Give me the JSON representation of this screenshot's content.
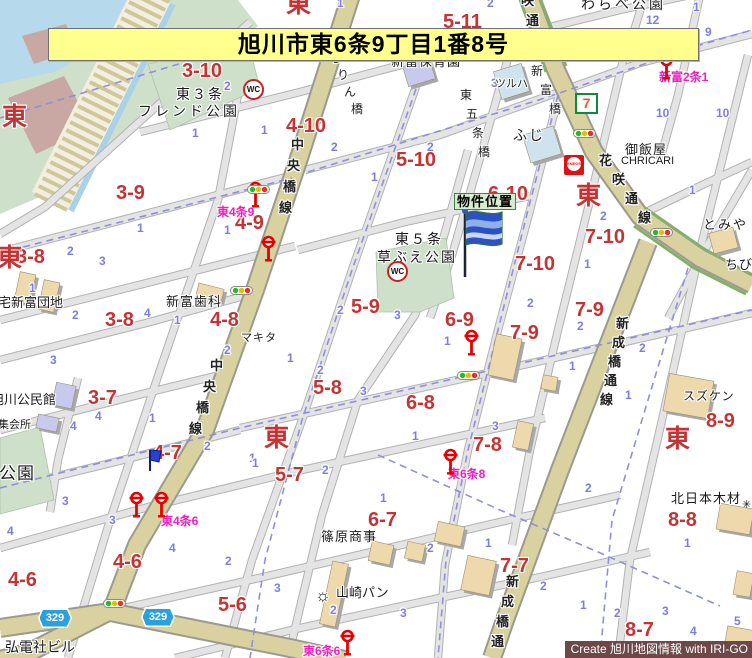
{
  "banner": {
    "title": "旭川市東6条9丁目1番8号"
  },
  "credit": {
    "text": "Create 旭川地図情報 with IRI-GO"
  },
  "property_marker": {
    "label": "物件位置"
  },
  "route_badges": [
    {
      "label": "329",
      "x": 38,
      "y": 608
    },
    {
      "label": "329",
      "x": 141,
      "y": 607
    }
  ],
  "map": {
    "road_names": [
      {
        "text": "中央橋線",
        "x": 291,
        "y": 138,
        "dx": -4,
        "dy": 21
      },
      {
        "text": "中央橋線",
        "x": 210,
        "y": 359,
        "dx": -7,
        "dy": 21
      },
      {
        "text": "新成橋通線",
        "x": 616,
        "y": 317,
        "dx": -4,
        "dy": 19
      },
      {
        "text": "新成橋通",
        "x": 506,
        "y": 575,
        "dx": -5,
        "dy": 20
      },
      {
        "text": "花咲通線",
        "x": 599,
        "y": 154,
        "dx": 13,
        "dy": 19
      },
      {
        "text": "咲通",
        "x": 521,
        "y": -6,
        "dx": 5,
        "dy": 20
      }
    ],
    "bridge_names": [
      {
        "text": "ろりん橋",
        "x": 330,
        "y": 52,
        "dx": 7,
        "dy": 17
      },
      {
        "text": "東五条橋",
        "x": 460,
        "y": 89,
        "dx": 6,
        "dy": 19
      },
      {
        "text": "新富橋",
        "x": 531,
        "y": 65,
        "dx": 9,
        "dy": 19
      }
    ],
    "district_marks": [
      {
        "text": "東",
        "x": 2,
        "y": 105
      },
      {
        "text": "東",
        "x": -3,
        "y": 246
      },
      {
        "text": "東",
        "x": 286,
        "y": -8
      },
      {
        "text": "東",
        "x": 576,
        "y": 184
      },
      {
        "text": "東",
        "x": 264,
        "y": 426
      },
      {
        "text": "東",
        "x": 665,
        "y": 427
      }
    ],
    "block_numbers": [
      {
        "text": "3-10",
        "x": 182,
        "y": 61
      },
      {
        "text": "4-10",
        "x": 286,
        "y": 116
      },
      {
        "text": "5-10",
        "x": 396,
        "y": 150
      },
      {
        "text": "5-11",
        "x": 443,
        "y": 12
      },
      {
        "text": "6-10",
        "x": 488,
        "y": 184
      },
      {
        "text": "7-10",
        "x": 515,
        "y": 254
      },
      {
        "text": "7-10",
        "x": 585,
        "y": 227
      },
      {
        "text": "3-9",
        "x": 116,
        "y": 183
      },
      {
        "text": "4-9",
        "x": 235,
        "y": 213
      },
      {
        "text": "3-8",
        "x": 16,
        "y": 247
      },
      {
        "text": "3-8",
        "x": 105,
        "y": 310
      },
      {
        "text": "4-8",
        "x": 210,
        "y": 310
      },
      {
        "text": "5-9",
        "x": 351,
        "y": 297
      },
      {
        "text": "6-9",
        "x": 445,
        "y": 310
      },
      {
        "text": "7-9",
        "x": 510,
        "y": 323
      },
      {
        "text": "7-9",
        "x": 575,
        "y": 300
      },
      {
        "text": "5-8",
        "x": 313,
        "y": 378
      },
      {
        "text": "6-8",
        "x": 406,
        "y": 393
      },
      {
        "text": "7-8",
        "x": 473,
        "y": 435
      },
      {
        "text": "8-9",
        "x": 706,
        "y": 411
      },
      {
        "text": "3-7",
        "x": 88,
        "y": 388
      },
      {
        "text": "4-7",
        "x": 153,
        "y": 443
      },
      {
        "text": "5-7",
        "x": 275,
        "y": 465
      },
      {
        "text": "6-7",
        "x": 368,
        "y": 510
      },
      {
        "text": "7-7",
        "x": 500,
        "y": 556
      },
      {
        "text": "8-8",
        "x": 668,
        "y": 510
      },
      {
        "text": "8-7",
        "x": 625,
        "y": 620
      },
      {
        "text": "4-6",
        "x": 8,
        "y": 570
      },
      {
        "text": "4-6",
        "x": 113,
        "y": 552
      },
      {
        "text": "5-6",
        "x": 218,
        "y": 595
      }
    ],
    "pink_bus_labels": [
      {
        "text": "東4条9",
        "x": 217,
        "y": 206
      },
      {
        "text": "東4条6",
        "x": 161,
        "y": 515
      },
      {
        "text": "東6条8",
        "x": 448,
        "y": 468
      },
      {
        "text": "東6条6",
        "x": 303,
        "y": 645
      },
      {
        "text": "新富2条1",
        "x": 659,
        "y": 71
      }
    ],
    "poi_labels": [
      {
        "text": "東３条",
        "x": 176,
        "y": 87,
        "size": 14,
        "ls": 2
      },
      {
        "text": "フレンド公園",
        "x": 138,
        "y": 104,
        "size": 14,
        "ls": 3
      },
      {
        "text": "新富保育園",
        "x": 391,
        "y": 55,
        "size": 13,
        "ls": 1
      },
      {
        "text": "わらべ公園",
        "x": 581,
        "y": -3,
        "size": 14,
        "ls": 3
      },
      {
        "text": "ツルハ",
        "x": 495,
        "y": 79,
        "size": 11,
        "ls": 0
      },
      {
        "text": "ふじ",
        "x": 513,
        "y": 128,
        "size": 14,
        "ls": 2
      },
      {
        "text": "御飯屋",
        "x": 625,
        "y": 143,
        "size": 13,
        "ls": 1
      },
      {
        "text": "CHRICARI",
        "x": 621,
        "y": 156,
        "size": 11,
        "ls": 0
      },
      {
        "text": "とみや",
        "x": 703,
        "y": 218,
        "size": 13,
        "ls": 2
      },
      {
        "text": "ちび",
        "x": 725,
        "y": 258,
        "size": 13,
        "ls": 1
      },
      {
        "text": "東５条",
        "x": 395,
        "y": 232,
        "size": 14,
        "ls": 2
      },
      {
        "text": "草ぶえ公園",
        "x": 377,
        "y": 250,
        "size": 14,
        "ls": 2
      },
      {
        "text": "新富歯科",
        "x": 166,
        "y": 295,
        "size": 13,
        "ls": 1
      },
      {
        "text": "マキタ",
        "x": 241,
        "y": 333,
        "size": 11,
        "ls": 1
      },
      {
        "text": "スズケン",
        "x": 683,
        "y": 390,
        "size": 12,
        "ls": 1
      },
      {
        "text": "宅新富団地",
        "x": -2,
        "y": 296,
        "size": 13,
        "ls": 0
      },
      {
        "text": "旭川公民館",
        "x": -9,
        "y": 393,
        "size": 13,
        "ls": 0
      },
      {
        "text": "集会所",
        "x": -2,
        "y": 420,
        "size": 11,
        "ls": 0
      },
      {
        "text": "公園",
        "x": -1,
        "y": 465,
        "size": 17,
        "ls": 1
      },
      {
        "text": "北日本木材",
        "x": 671,
        "y": 492,
        "size": 13,
        "ls": 1
      },
      {
        "text": "篠原商事",
        "x": 321,
        "y": 530,
        "size": 13,
        "ls": 1
      },
      {
        "text": "山崎パン",
        "x": 336,
        "y": 586,
        "size": 13,
        "ls": 0
      },
      {
        "text": "弘電社ビル",
        "x": 5,
        "y": 640,
        "size": 14,
        "ls": 0
      }
    ],
    "lot_numbers": [
      {
        "text": "1",
        "x": 337,
        "y": -3
      },
      {
        "text": "2",
        "x": 487,
        "y": -3
      },
      {
        "text": "12",
        "x": 646,
        "y": 14
      },
      {
        "text": "9",
        "x": 705,
        "y": 26
      },
      {
        "text": "1",
        "x": 693,
        "y": 1
      },
      {
        "text": "10",
        "x": 656,
        "y": 107
      },
      {
        "text": "10",
        "x": 716,
        "y": 107
      },
      {
        "text": "1",
        "x": 689,
        "y": 184
      },
      {
        "text": "2",
        "x": 600,
        "y": 210
      },
      {
        "text": "1",
        "x": 584,
        "y": 258
      },
      {
        "text": "2",
        "x": 331,
        "y": 141
      },
      {
        "text": "2",
        "x": 427,
        "y": 141
      },
      {
        "text": "2",
        "x": 224,
        "y": 80
      },
      {
        "text": "1",
        "x": 192,
        "y": 127
      },
      {
        "text": "1",
        "x": 261,
        "y": 124
      },
      {
        "text": "1",
        "x": 371,
        "y": 171
      },
      {
        "text": "1",
        "x": 137,
        "y": 222
      },
      {
        "text": "1",
        "x": 224,
        "y": 224
      },
      {
        "text": "2",
        "x": 67,
        "y": 245
      },
      {
        "text": "3",
        "x": 99,
        "y": 255
      },
      {
        "text": "1",
        "x": 29,
        "y": 282
      },
      {
        "text": "2",
        "x": 72,
        "y": 309
      },
      {
        "text": "4",
        "x": 144,
        "y": 307
      },
      {
        "text": "1",
        "x": 174,
        "y": 314
      },
      {
        "text": "2",
        "x": 224,
        "y": 344
      },
      {
        "text": "3",
        "x": 50,
        "y": 354
      },
      {
        "text": "4",
        "x": 95,
        "y": 410
      },
      {
        "text": "4",
        "x": 70,
        "y": 420
      },
      {
        "text": "1",
        "x": 149,
        "y": 412
      },
      {
        "text": "2",
        "x": 204,
        "y": 440
      },
      {
        "text": "3",
        "x": 62,
        "y": 495
      },
      {
        "text": "3",
        "x": 109,
        "y": 514
      },
      {
        "text": "4",
        "x": 7,
        "y": 525
      },
      {
        "text": "4",
        "x": 169,
        "y": 542
      },
      {
        "text": "1",
        "x": 249,
        "y": 452
      },
      {
        "text": "2",
        "x": 225,
        "y": 555
      },
      {
        "text": "2",
        "x": 337,
        "y": 304
      },
      {
        "text": "3",
        "x": 394,
        "y": 309
      },
      {
        "text": "1",
        "x": 444,
        "y": 335
      },
      {
        "text": "1",
        "x": 287,
        "y": 352
      },
      {
        "text": "2",
        "x": 317,
        "y": 364
      },
      {
        "text": "3",
        "x": 360,
        "y": 385
      },
      {
        "text": "1",
        "x": 412,
        "y": 430
      },
      {
        "text": "3",
        "x": 492,
        "y": 420
      },
      {
        "text": "1",
        "x": 252,
        "y": 457
      },
      {
        "text": "2",
        "x": 322,
        "y": 464
      },
      {
        "text": "2",
        "x": 527,
        "y": 297
      },
      {
        "text": "1",
        "x": 380,
        "y": 492
      },
      {
        "text": "2",
        "x": 427,
        "y": 542
      },
      {
        "text": "1",
        "x": 485,
        "y": 537
      },
      {
        "text": "3",
        "x": 274,
        "y": 582
      },
      {
        "text": "2",
        "x": 330,
        "y": 604
      },
      {
        "text": "3",
        "x": 400,
        "y": 607
      },
      {
        "text": "2",
        "x": 585,
        "y": 482
      },
      {
        "text": "1",
        "x": 684,
        "y": 537
      },
      {
        "text": "2",
        "x": 540,
        "y": 580
      },
      {
        "text": "1",
        "x": 580,
        "y": 599
      },
      {
        "text": "2",
        "x": 614,
        "y": 607
      },
      {
        "text": "3",
        "x": 662,
        "y": 605
      },
      {
        "text": "4",
        "x": 690,
        "y": 625
      },
      {
        "text": "5",
        "x": 734,
        "y": 615
      },
      {
        "text": "2",
        "x": 577,
        "y": 320
      },
      {
        "text": "2",
        "x": 639,
        "y": 342
      },
      {
        "text": "1",
        "x": 569,
        "y": 360
      },
      {
        "text": "1",
        "x": 625,
        "y": 389
      },
      {
        "text": "3",
        "x": 491,
        "y": 77
      }
    ],
    "bus_stop_positions": [
      {
        "x": 248,
        "y": 181
      },
      {
        "x": 261,
        "y": 235
      },
      {
        "x": 464,
        "y": 329
      },
      {
        "x": 443,
        "y": 448
      },
      {
        "x": 129,
        "y": 491
      },
      {
        "x": 154,
        "y": 491
      },
      {
        "x": 340,
        "y": 629
      },
      {
        "x": 659,
        "y": 53
      }
    ],
    "traffic_light_positions": [
      {
        "x": 573,
        "y": 129
      },
      {
        "x": 650,
        "y": 228
      },
      {
        "x": 247,
        "y": 185
      },
      {
        "x": 230,
        "y": 286
      },
      {
        "x": 457,
        "y": 371
      },
      {
        "x": 103,
        "y": 599
      }
    ],
    "icons": {
      "wc_label": "WC",
      "wc_positions": [
        {
          "x": 243,
          "y": 79
        },
        {
          "x": 387,
          "y": 261
        }
      ],
      "seven_eleven": {
        "label": "7",
        "x": 575,
        "y": 93
      },
      "eneos": {
        "label": "ENEOS",
        "x": 564,
        "y": 155
      },
      "factory": {
        "glyph": "☼",
        "x": 315,
        "y": 587
      },
      "blue_flag": {
        "x": 146,
        "y": 448
      },
      "company_mark": {
        "glyph": "✳",
        "x": 742,
        "y": 500
      }
    }
  }
}
